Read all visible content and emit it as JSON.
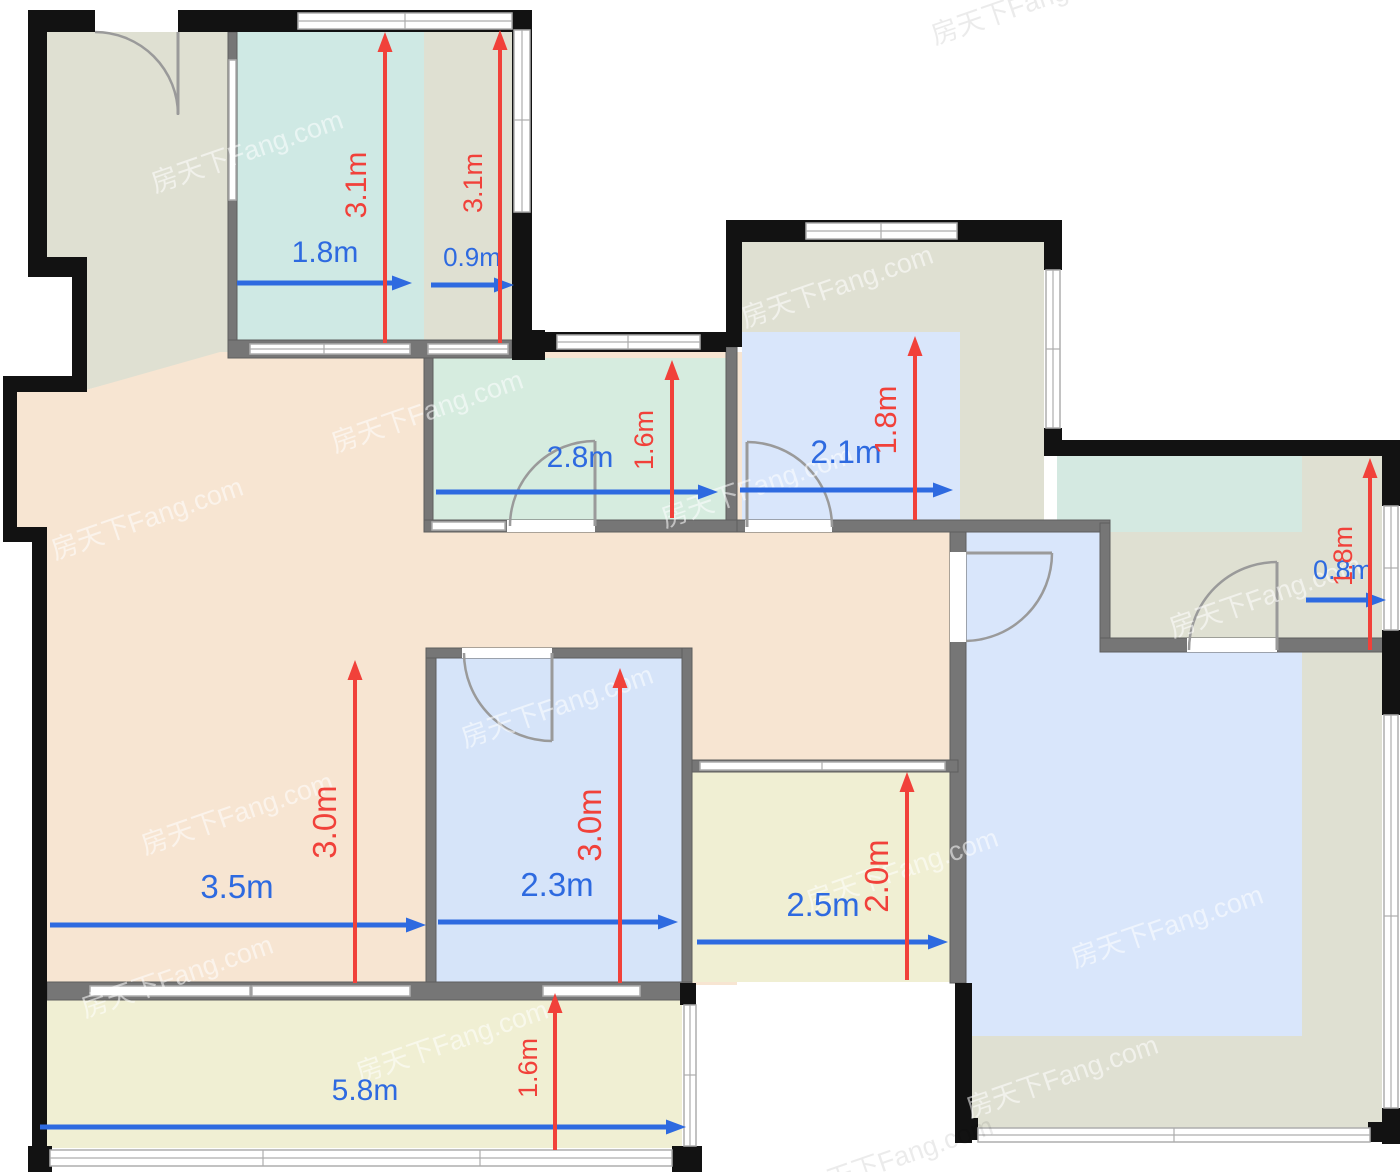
{
  "meta": {
    "type": "apartment-floor-plan"
  },
  "colors": {
    "peach": "#f7e5d2",
    "olive": "#dfe0d2",
    "teal_bedroom": "#cfe9e4",
    "teal_kitchen": "#d6ecdf",
    "teal_bath": "#d4e9e1",
    "blue_room": "#d6e4f9",
    "blue_hl": "#d9e6fb",
    "yellow": "#f0efd3",
    "wall_black": "#121212",
    "wall_gray": "#767676",
    "window_line": "#adadad",
    "door": "#9a9a9a",
    "dim_blue": "#2e6ae0",
    "dim_red": "#f1413a"
  },
  "watermark": {
    "text": "房天下Fang.com",
    "white_positions": [
      [
        250,
        160
      ],
      [
        430,
        420
      ],
      [
        150,
        527
      ],
      [
        760,
        495
      ],
      [
        1185,
        350
      ],
      [
        240,
        822
      ],
      [
        560,
        715
      ],
      [
        905,
        878
      ],
      [
        1268,
        605
      ],
      [
        1170,
        935
      ],
      [
        455,
        1050
      ],
      [
        1065,
        1085
      ],
      [
        180,
        985
      ],
      [
        840,
        295
      ]
    ],
    "gray_positions": [
      [
        1030,
        12
      ],
      [
        900,
        1166
      ]
    ]
  },
  "dimensions": {
    "horizontal": [
      {
        "room": "bedroom-top",
        "label": "1.8m",
        "x1": 237,
        "x2": 412,
        "y": 283,
        "lx": 325,
        "ly": 262,
        "fs": 30
      },
      {
        "room": "wardrobe-strip",
        "label": "0.9m",
        "x1": 431,
        "x2": 514,
        "y": 285,
        "lx": 472,
        "ly": 266,
        "fs": 26
      },
      {
        "room": "kitchen",
        "label": "2.8m",
        "x1": 436,
        "x2": 718,
        "y": 492,
        "lx": 580,
        "ly": 467,
        "fs": 30
      },
      {
        "room": "room-2-1",
        "label": "2.1m",
        "x1": 740,
        "x2": 953,
        "y": 490,
        "lx": 846,
        "ly": 463,
        "fs": 32
      },
      {
        "room": "bathroom",
        "label": "0.8m",
        "x1": 1306,
        "x2": 1386,
        "y": 600,
        "lx": 1343,
        "ly": 579,
        "fs": 27
      },
      {
        "room": "living",
        "label": "3.5m",
        "x1": 50,
        "x2": 426,
        "y": 925,
        "lx": 237,
        "ly": 898,
        "fs": 33
      },
      {
        "room": "room-2-3",
        "label": "2.3m",
        "x1": 438,
        "x2": 678,
        "y": 922,
        "lx": 557,
        "ly": 896,
        "fs": 33
      },
      {
        "room": "yellow-room",
        "label": "2.5m",
        "x1": 697,
        "x2": 948,
        "y": 942,
        "lx": 823,
        "ly": 916,
        "fs": 33
      },
      {
        "room": "balcony",
        "label": "5.8m",
        "x1": 40,
        "x2": 686,
        "y": 1127,
        "lx": 365,
        "ly": 1100,
        "fs": 30
      }
    ],
    "vertical": [
      {
        "room": "bedroom-top",
        "label": "3.1m",
        "x": 385,
        "y1": 343,
        "y2": 32,
        "lx": 366,
        "ly": 185,
        "fs": 30
      },
      {
        "room": "wardrobe-strip",
        "label": "3.1m",
        "x": 500,
        "y1": 343,
        "y2": 30,
        "lx": 482,
        "ly": 183,
        "fs": 27
      },
      {
        "room": "kitchen",
        "label": "1.6m",
        "x": 672,
        "y1": 518,
        "y2": 360,
        "lx": 653,
        "ly": 440,
        "fs": 27
      },
      {
        "room": "room-2-1",
        "label": "1.8m",
        "x": 915,
        "y1": 520,
        "y2": 336,
        "lx": 896,
        "ly": 420,
        "fs": 31
      },
      {
        "room": "bathroom",
        "label": "1.8m",
        "x": 1370,
        "y1": 650,
        "y2": 458,
        "lx": 1352,
        "ly": 556,
        "fs": 27
      },
      {
        "room": "living",
        "label": "3.0m",
        "x": 355,
        "y1": 983,
        "y2": 660,
        "lx": 336,
        "ly": 822,
        "fs": 33
      },
      {
        "room": "room-2-3",
        "label": "3.0m",
        "x": 620,
        "y1": 983,
        "y2": 668,
        "lx": 601,
        "ly": 825,
        "fs": 33
      },
      {
        "room": "yellow-room",
        "label": "2.0m",
        "x": 907,
        "y1": 980,
        "y2": 772,
        "lx": 888,
        "ly": 876,
        "fs": 33
      },
      {
        "room": "balcony",
        "label": "1.6m",
        "x": 555,
        "y1": 1150,
        "y2": 993,
        "lx": 537,
        "ly": 1068,
        "fs": 27
      }
    ]
  }
}
